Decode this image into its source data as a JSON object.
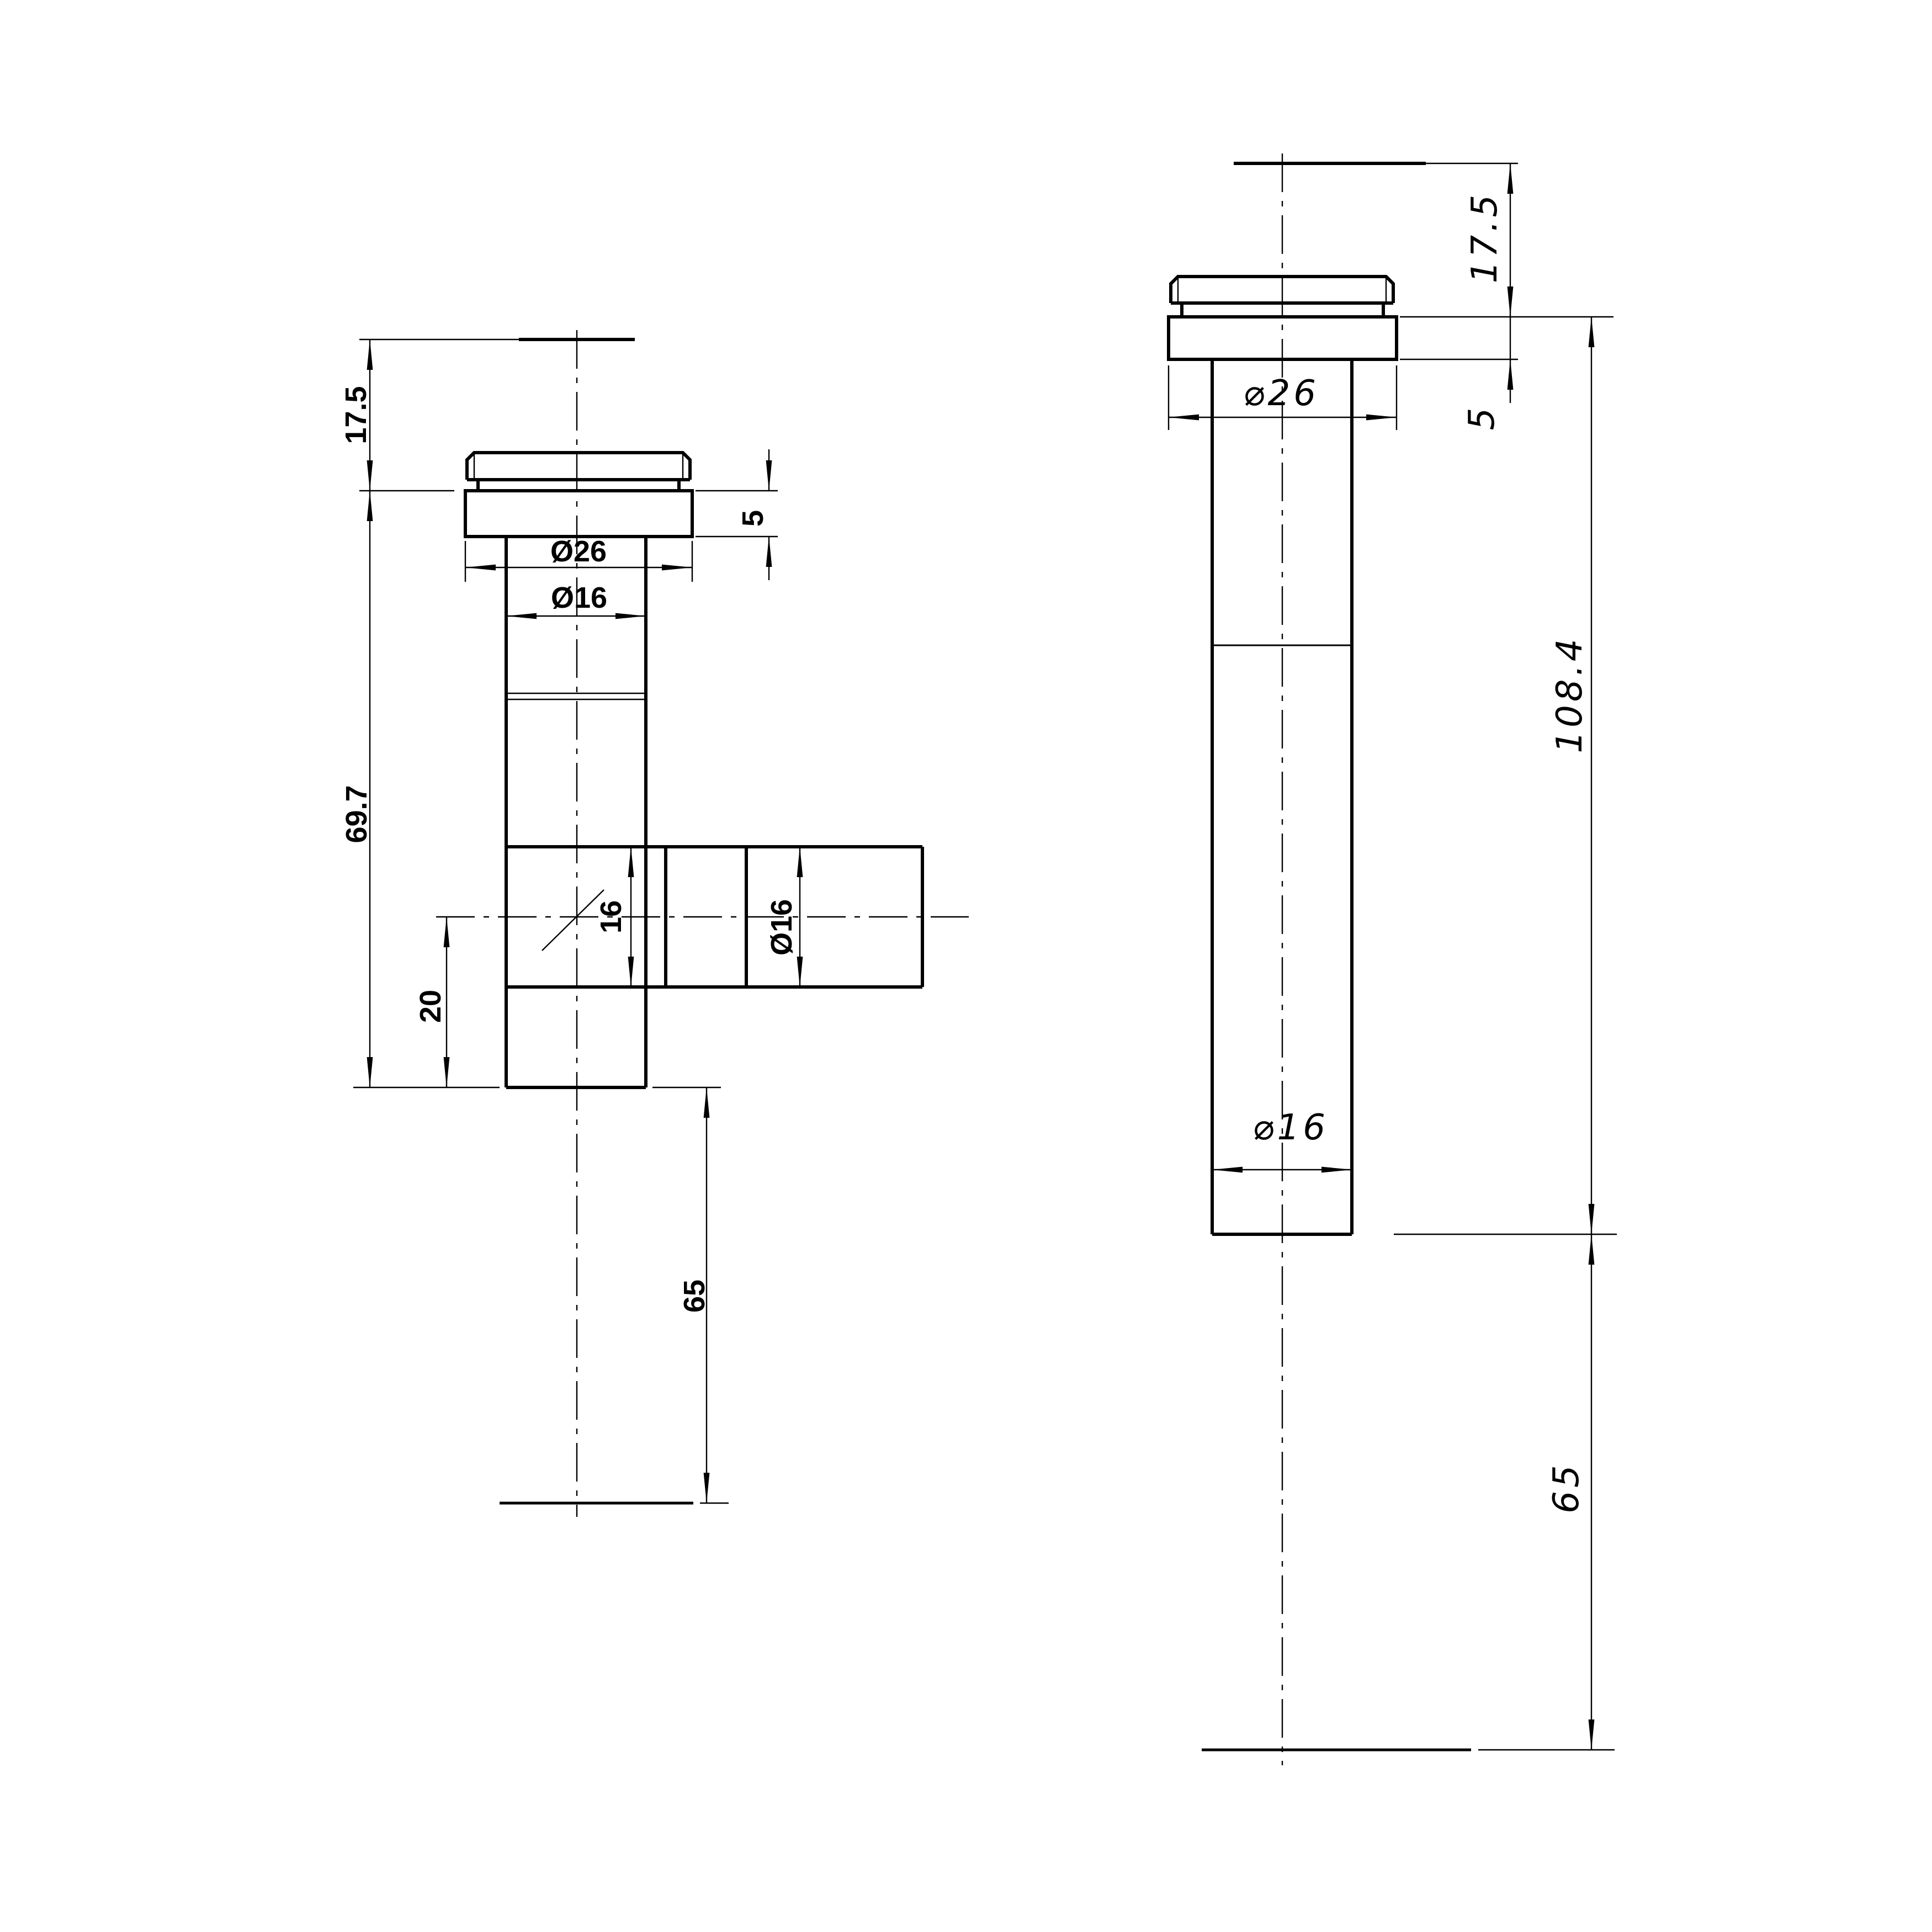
{
  "title": "pipe fitting technical drawing",
  "colors": {
    "background": "#ffffff",
    "ink": "#000000"
  },
  "views": {
    "side_view": {
      "name": "tee fitting side section view",
      "dimensions": {
        "cap_height": "17.5",
        "body_length": "69.7",
        "branch_offset": "20",
        "tail_length": "65",
        "flange_thickness": "5",
        "flange_diameter": "Ø26",
        "tube_diameter": "Ø16",
        "branch_bore": "16",
        "branch_diameter": "Ø16"
      }
    },
    "front_view": {
      "name": "straight fitting front view",
      "dimensions": {
        "cap_height": "17.5",
        "flange_thickness": "5",
        "flange_diameter": "⌀26",
        "overall_length": "108.4",
        "tube_diameter": "⌀16",
        "tail_length": "65"
      }
    }
  }
}
